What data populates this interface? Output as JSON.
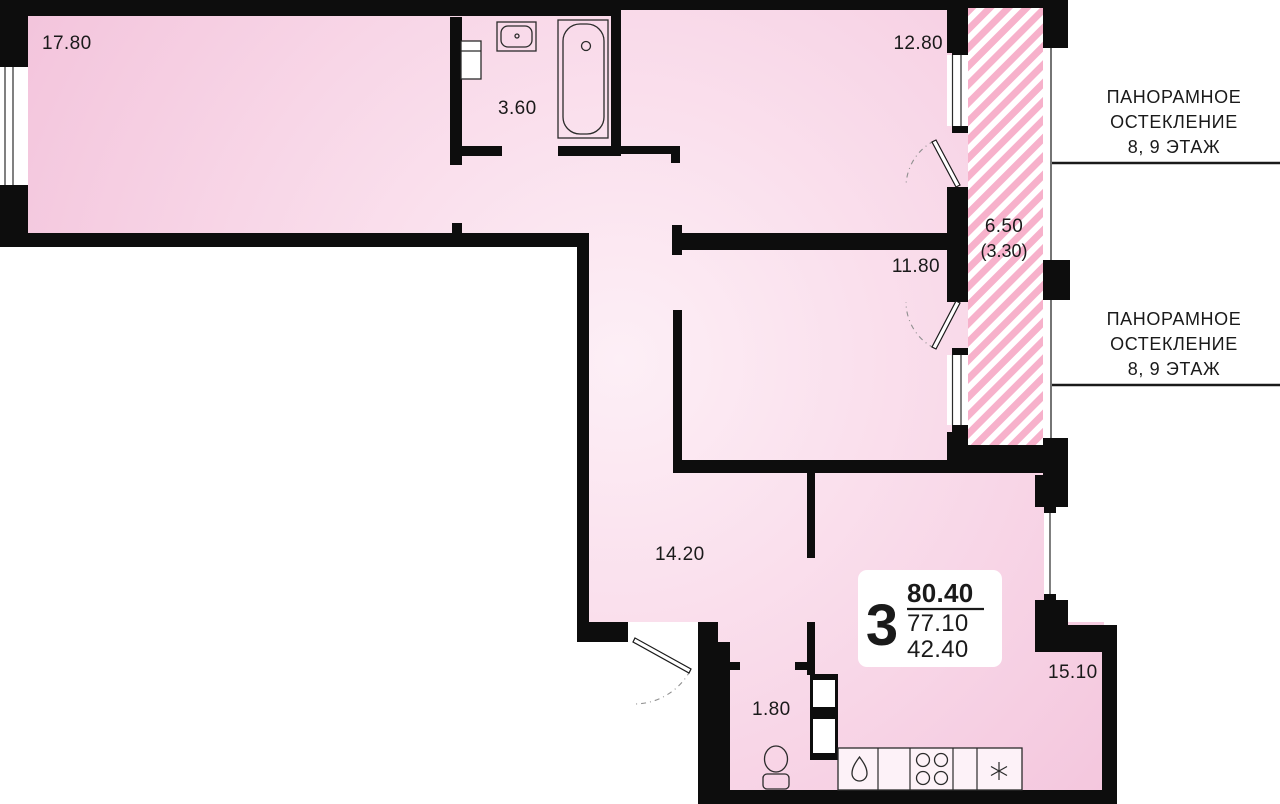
{
  "plan": {
    "rooms": [
      {
        "name": "room-17",
        "area": "17.80"
      },
      {
        "name": "bathroom",
        "area": "3.60"
      },
      {
        "name": "room-12",
        "area": "12.80"
      },
      {
        "name": "room-11",
        "area": "11.80"
      },
      {
        "name": "hallway",
        "area": "14.20"
      },
      {
        "name": "wc",
        "area": "1.80"
      },
      {
        "name": "kitchen-living",
        "area": "15.10"
      }
    ],
    "balcony": {
      "area": "6.50",
      "area_coefficient": "(3.30)"
    },
    "glazing_note_top": {
      "line1": "ПАНОРАМНОЕ",
      "line2": "ОСТЕКЛЕНИЕ",
      "line3": "8, 9 ЭТАЖ"
    },
    "glazing_note_bottom": {
      "line1": "ПАНОРАМНОЕ",
      "line2": "ОСТЕКЛЕНИЕ",
      "line3": "8, 9 ЭТАЖ"
    },
    "summary": {
      "rooms_count": "3",
      "area_total": "80.40",
      "area_without_balcony": "77.10",
      "area_living": "42.40"
    }
  },
  "colors": {
    "wall": "#0d0d0d",
    "room_fill_light": "#fdeff6",
    "room_fill_dark": "#f2c1da",
    "balcony_hatch_stripe": "#f7b1cb",
    "text": "#1a1a1a"
  }
}
